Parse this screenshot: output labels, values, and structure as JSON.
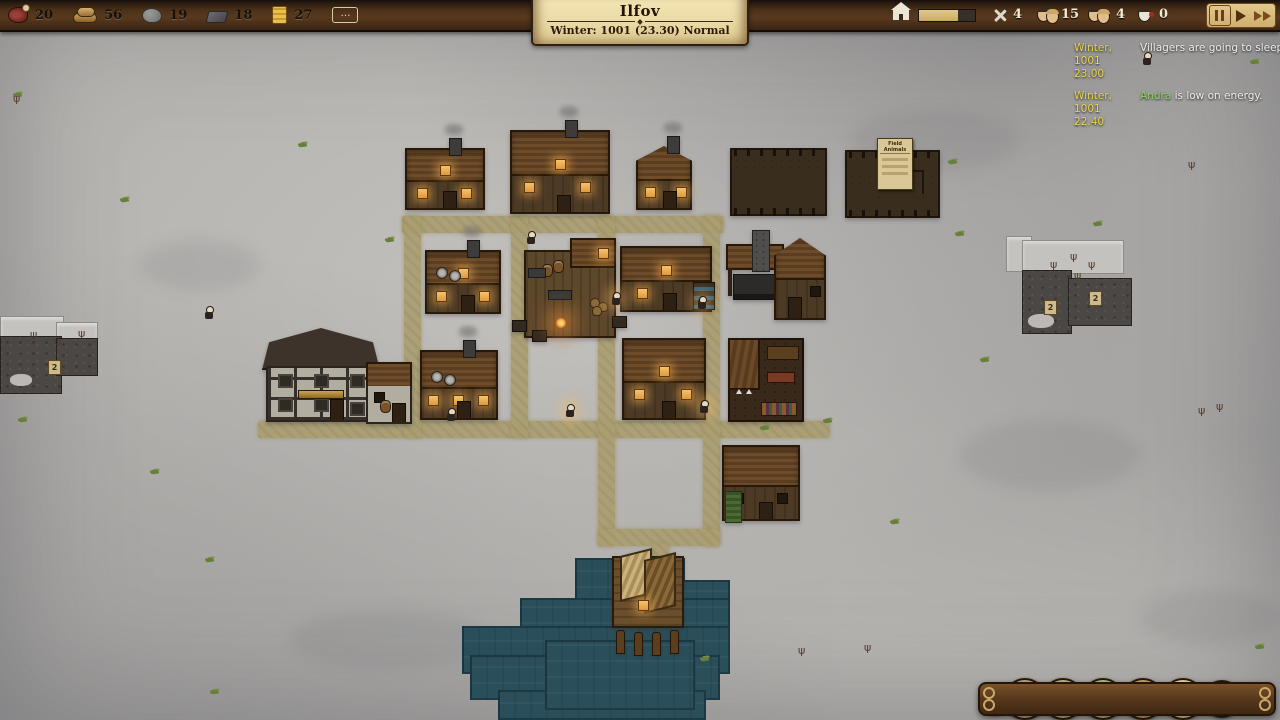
{
  "top_bar": {
    "resources": [
      {
        "name": "meat",
        "value": "20"
      },
      {
        "name": "wood",
        "value": "56"
      },
      {
        "name": "stone",
        "value": "19"
      },
      {
        "name": "iron",
        "value": "18"
      },
      {
        "name": "gold",
        "value": "27"
      }
    ],
    "more_label": "…",
    "settlement": {
      "title": "Ilfov",
      "subtitle": "Winter: 1001 (23.30) Normal"
    },
    "housing": {
      "progress_pct": 70
    },
    "stats": [
      {
        "name": "military",
        "value": "4"
      },
      {
        "name": "population",
        "value": "15"
      },
      {
        "name": "adults",
        "value": "4"
      },
      {
        "name": "sick",
        "value": "0"
      }
    ]
  },
  "notifications": [
    {
      "date": "Winter,",
      "time": "1001 23.00",
      "subject": "",
      "message": "Villagers are going to sleep."
    },
    {
      "date": "Winter,",
      "time": "1001 22.40",
      "subject": "Andra",
      "message": " is low on energy."
    }
  ],
  "toolbar": {
    "buttons": [
      {
        "name": "tools",
        "glyph": "⚒"
      },
      {
        "name": "build",
        "glyph": "⚒"
      },
      {
        "name": "families",
        "glyph": "☺"
      },
      {
        "name": "professions",
        "glyph": "✎"
      },
      {
        "name": "ledger",
        "glyph": "▤"
      },
      {
        "name": "resources",
        "glyph": "∷"
      },
      {
        "name": "settings",
        "glyph": "⚙"
      },
      {
        "name": "help",
        "glyph": "?"
      }
    ]
  },
  "map": {
    "elevation_label": "2",
    "field_sign_title": "Field Animals",
    "roads": [
      {
        "x": 402,
        "y": 216,
        "w": 322,
        "h": 17
      },
      {
        "x": 258,
        "y": 421,
        "w": 572,
        "h": 17
      },
      {
        "x": 404,
        "y": 216,
        "w": 17,
        "h": 222
      },
      {
        "x": 511,
        "y": 216,
        "w": 17,
        "h": 222
      },
      {
        "x": 598,
        "y": 216,
        "w": 17,
        "h": 330
      },
      {
        "x": 703,
        "y": 216,
        "w": 17,
        "h": 330
      },
      {
        "x": 598,
        "y": 529,
        "w": 122,
        "h": 17
      },
      {
        "x": 652,
        "y": 543,
        "w": 17,
        "h": 20
      }
    ],
    "water": [
      {
        "x": 575,
        "y": 558,
        "w": 110,
        "h": 46
      },
      {
        "x": 680,
        "y": 580,
        "w": 50,
        "h": 60
      },
      {
        "x": 520,
        "y": 598,
        "w": 210,
        "h": 42
      },
      {
        "x": 462,
        "y": 626,
        "w": 268,
        "h": 48
      },
      {
        "x": 470,
        "y": 655,
        "w": 250,
        "h": 45
      },
      {
        "x": 498,
        "y": 690,
        "w": 208,
        "h": 30
      },
      {
        "x": 545,
        "y": 640,
        "w": 150,
        "h": 70
      }
    ],
    "buildings": [
      {
        "t": "house",
        "x": 405,
        "y": 148,
        "w": 80,
        "h": 62,
        "wn": 2,
        "dw": 1,
        "ch": 1
      },
      {
        "t": "house",
        "x": 510,
        "y": 130,
        "w": 100,
        "h": 84,
        "wn": 2,
        "dw": 1,
        "ch": 1
      },
      {
        "t": "house",
        "x": 636,
        "y": 146,
        "w": 56,
        "h": 64,
        "wn": 2,
        "dw": 0,
        "ch": 1
      },
      {
        "t": "field",
        "x": 730,
        "y": 148,
        "w": 97,
        "h": 68
      },
      {
        "t": "field",
        "x": 845,
        "y": 150,
        "w": 95,
        "h": 68,
        "sign": 1
      },
      {
        "t": "house",
        "x": 425,
        "y": 250,
        "w": 76,
        "h": 64,
        "wn": 2,
        "dw": 1,
        "ch": 1,
        "decor": 1
      },
      {
        "t": "platform",
        "x": 524,
        "y": 238,
        "w": 92,
        "h": 100
      },
      {
        "t": "house",
        "x": 620,
        "y": 246,
        "w": 92,
        "h": 66,
        "wn": 1,
        "dw": 1,
        "stall": 1
      },
      {
        "t": "forge",
        "x": 726,
        "y": 238,
        "w": 100,
        "h": 82
      },
      {
        "t": "timber",
        "x": 262,
        "y": 328,
        "w": 150,
        "h": 98
      },
      {
        "t": "house",
        "x": 420,
        "y": 350,
        "w": 78,
        "h": 70,
        "wn": 3,
        "dw": 0,
        "ch": 1,
        "decor": 1
      },
      {
        "t": "house",
        "x": 622,
        "y": 338,
        "w": 84,
        "h": 82,
        "wn": 2,
        "dw": 1
      },
      {
        "t": "workshop",
        "x": 728,
        "y": 338,
        "w": 76,
        "h": 84
      },
      {
        "t": "house",
        "x": 722,
        "y": 445,
        "w": 78,
        "h": 76,
        "wn": 2,
        "dw": 0,
        "dark": 1,
        "plant": 1
      },
      {
        "t": "dock",
        "x": 612,
        "y": 556,
        "w": 72,
        "h": 98
      }
    ],
    "props": {
      "villagers": [
        [
          527,
          231,
          0
        ],
        [
          205,
          306,
          0
        ],
        [
          612,
          292,
          1
        ],
        [
          698,
          296,
          1
        ],
        [
          566,
          404,
          1
        ],
        [
          700,
          400,
          1
        ],
        [
          447,
          408,
          0
        ],
        [
          1143,
          52,
          0
        ]
      ],
      "grass": [
        [
          298,
          143
        ],
        [
          948,
          160
        ],
        [
          955,
          232
        ],
        [
          120,
          198
        ],
        [
          385,
          238
        ],
        [
          205,
          558
        ],
        [
          700,
          657
        ],
        [
          760,
          426
        ],
        [
          823,
          419
        ],
        [
          1093,
          222
        ],
        [
          640,
          17
        ],
        [
          13,
          93
        ],
        [
          210,
          690
        ],
        [
          980,
          358
        ],
        [
          1250,
          60
        ],
        [
          18,
          418
        ],
        [
          1255,
          645
        ],
        [
          355,
          15
        ],
        [
          150,
          470
        ],
        [
          890,
          520
        ]
      ],
      "shrubs": [
        [
          30,
          330
        ],
        [
          54,
          337
        ],
        [
          78,
          329
        ],
        [
          1050,
          260
        ],
        [
          1070,
          252
        ],
        [
          1088,
          260
        ],
        [
          1074,
          271
        ],
        [
          13,
          94
        ],
        [
          1188,
          160
        ],
        [
          1198,
          406
        ],
        [
          1216,
          402
        ],
        [
          798,
          646
        ],
        [
          864,
          643
        ]
      ],
      "markers": [
        [
          48,
          360
        ],
        [
          1044,
          300
        ],
        [
          1089,
          291
        ]
      ]
    }
  },
  "colors": {
    "parchment": "#ead9a4",
    "road": "#ab9e71",
    "water": "#2a4f5b",
    "window_glow": "#f2b156",
    "notification_time": "#e6d44e",
    "subject_green": "#8fd06a"
  }
}
